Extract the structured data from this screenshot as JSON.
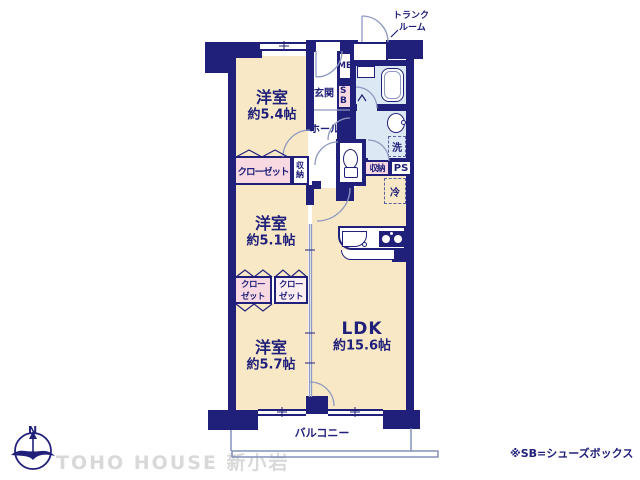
{
  "floorplan": {
    "rooms": {
      "bedroom1": {
        "name": "洋室",
        "size": "約5.4帖"
      },
      "bedroom2": {
        "name": "洋室",
        "size": "約5.1帖"
      },
      "bedroom3": {
        "name": "洋室",
        "size": "約5.7帖"
      },
      "ldk": {
        "name": "LDK",
        "size": "約15.6帖"
      }
    },
    "areas": {
      "entrance": "玄関",
      "hall": "ホール",
      "balcony": "バルコニー",
      "trunk_room_line1": "トランク",
      "trunk_room_line2": "ルーム",
      "meter_box": "MB",
      "shoe_box": "SB",
      "closet_large": "クローゼット",
      "closet_small_line1": "クロー",
      "closet_small_line2": "ゼット",
      "storage": "収納",
      "pipe_space": "PS",
      "laundry": "洗",
      "refrigerator": "冷"
    },
    "annotations": {
      "note": "※SB=シューズボックス",
      "watermark": "TOHO HOUSE 新小岩",
      "compass_north": "N"
    },
    "colors": {
      "wall": "#20207a",
      "room_floor": "#f8e8c6",
      "wet_floor": "#dce8f4",
      "closet_pink": "#f8d9e1",
      "text": "#20207a",
      "watermark": "#d9d9d9"
    }
  }
}
